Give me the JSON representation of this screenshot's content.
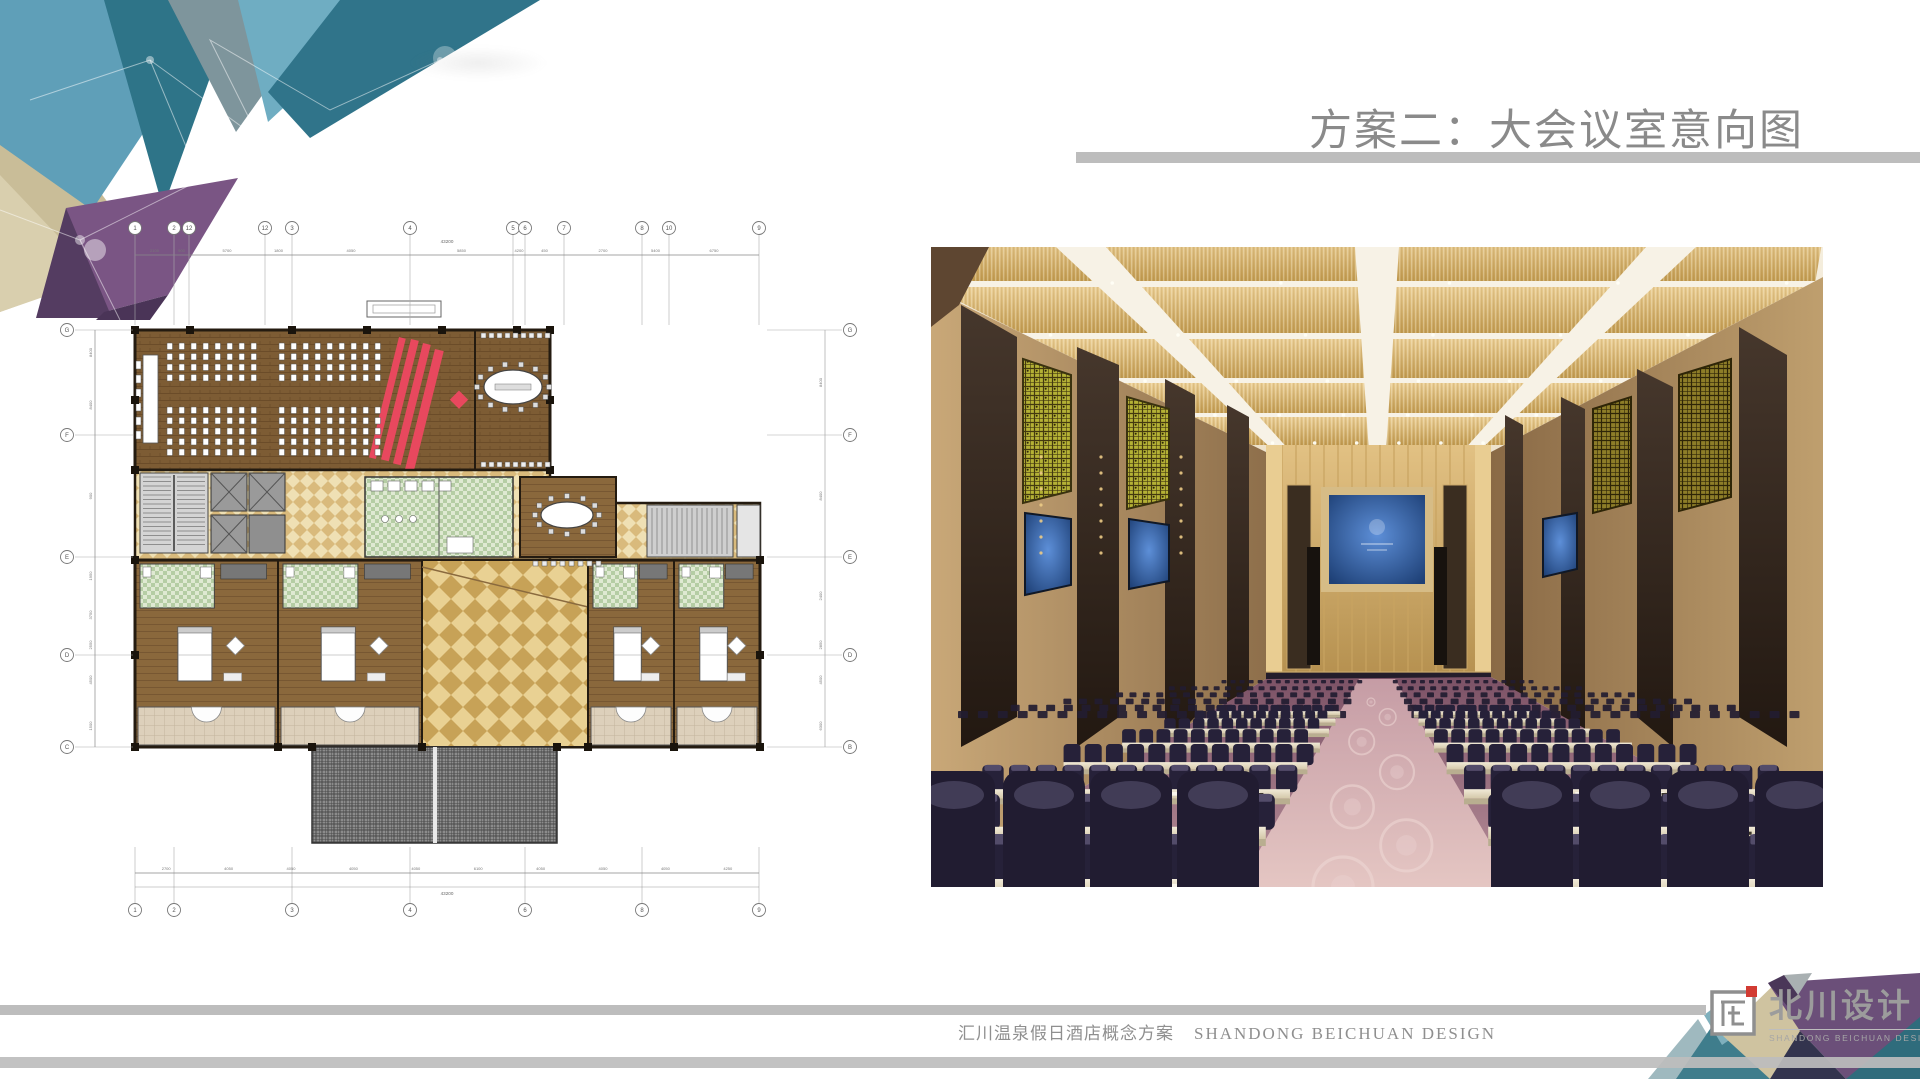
{
  "slide": {
    "title": "方案二：大会议室意向图",
    "footer": {
      "project": "汇川温泉假日酒店概念方案",
      "studio": "SHANDONG BEICHUAN DESIGN"
    },
    "logo": {
      "name": "北川设计",
      "sub": "SHANDONG BEICHUAN DESIGN"
    }
  },
  "floor_plan": {
    "grid_top": [
      "1",
      "2",
      "12",
      "12",
      "3",
      "4",
      "5",
      "6",
      "7",
      "8",
      "10",
      "9"
    ],
    "grid_bottom": [
      "1",
      "2",
      "3",
      "4",
      "6",
      "8",
      "9"
    ],
    "grid_left": [
      "G",
      "F",
      "E",
      "D",
      "C"
    ],
    "grid_right": [
      "G",
      "F",
      "E",
      "D",
      "B"
    ],
    "dims_top": [
      "2100",
      "900",
      "5700",
      "1800",
      "4050",
      "5850",
      "4200",
      "450",
      "2700",
      "5400",
      "6750"
    ],
    "dims_top_total": "43200",
    "dims_bottom": [
      "2700",
      "4050",
      "4050",
      "4050",
      "4050",
      "6100",
      "4050",
      "4050",
      "4050",
      "4250"
    ],
    "dims_bottom_total": "43200",
    "dims_left": [
      "8400",
      "8400",
      "900",
      "1950",
      "3750",
      "2550",
      "4500",
      "1500"
    ],
    "dims_right": [
      "8400",
      "8400",
      "2400",
      "2850",
      "4500",
      "6300"
    ]
  },
  "colors": {
    "title_gray": "#8a8a8a",
    "bar_gray": "#bdbdbd",
    "deco": {
      "teal_light": "#5f9fb8",
      "teal_dark": "#2e7488",
      "gray_teal": "#7e959c",
      "khaki": "#c9bd98",
      "purple": "#7a5584",
      "purple_dark": "#543c61"
    },
    "plan": {
      "wood": "#7d5c34",
      "wood_room": "#8a683c",
      "checker_a": "#efe0b4",
      "checker_b": "#d9ba7c",
      "green_tile": "#cfdfbe",
      "red": "#e8485e",
      "gray": "#9a9a9a"
    },
    "hall": {
      "ceiling": "#f2e9d8",
      "gold": "#d9b36c",
      "wall": "#b5925f",
      "lattice": "#b4b135",
      "screen_blue": "#2a5fae",
      "carpet": "#9c6e7e",
      "aisle": "#cfa8b0",
      "chair": "#241f36",
      "table": "#e6ddc8",
      "logo_red": "#d23b33"
    }
  }
}
